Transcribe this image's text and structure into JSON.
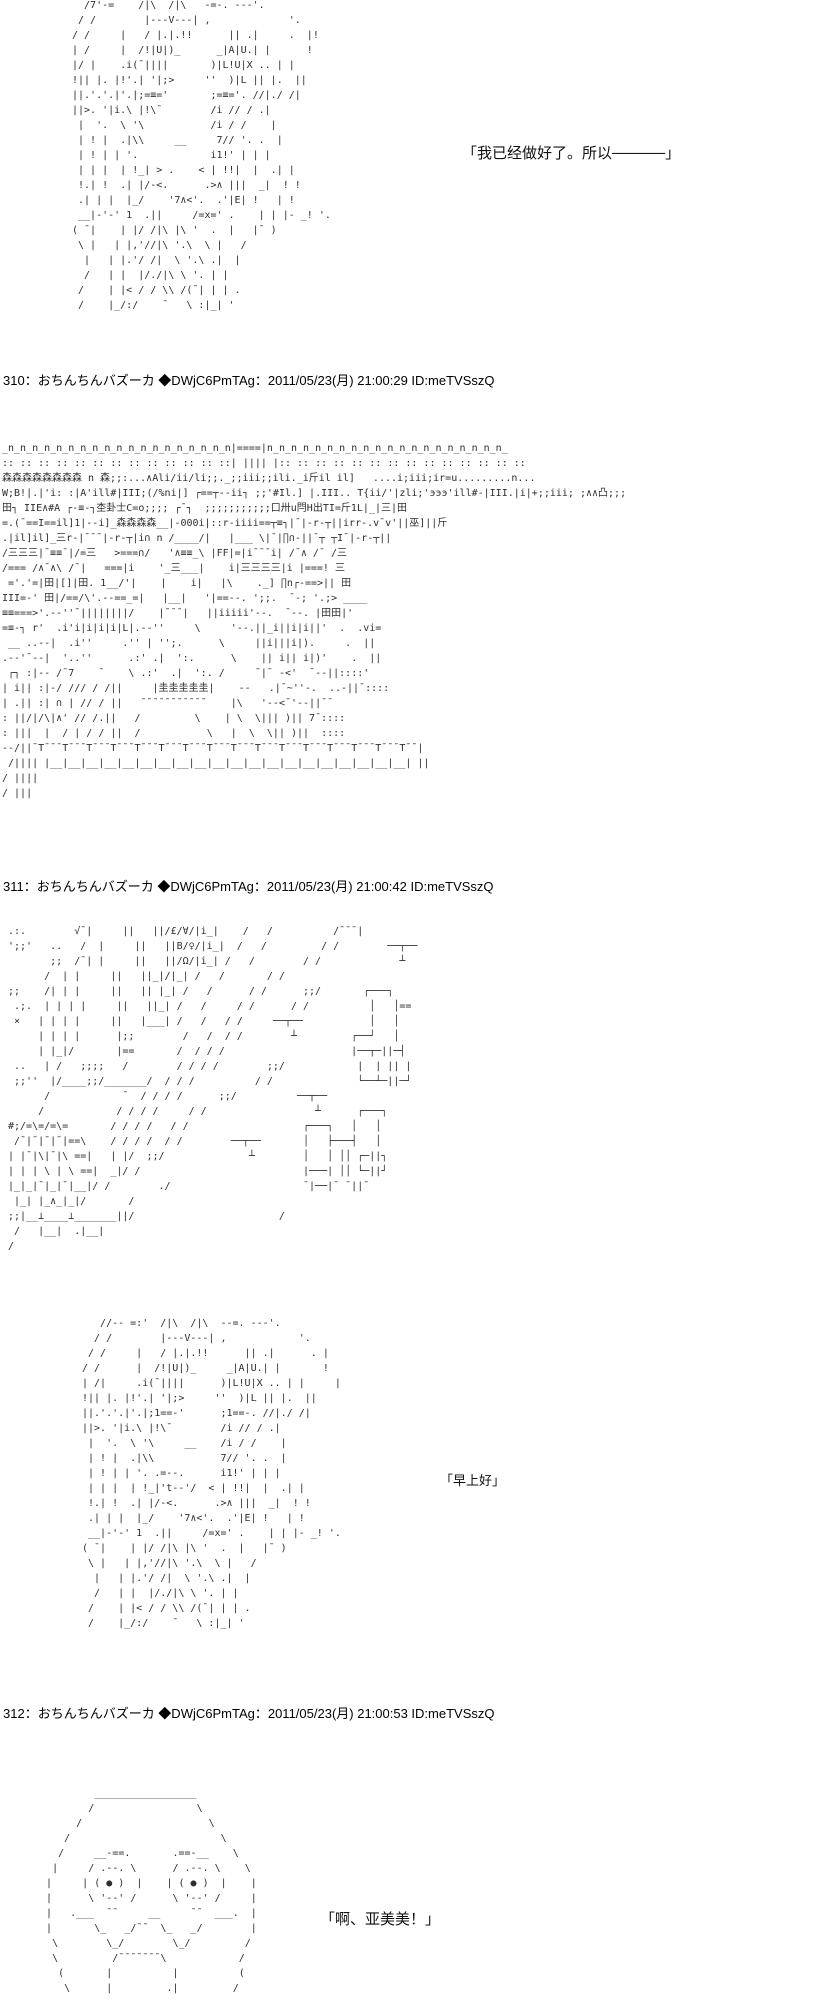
{
  "page": {
    "background": "#ffffff",
    "text_color": "#000000",
    "aa_color": "#2e2e2e",
    "kind": "ascii-art thread page"
  },
  "posts": [
    {
      "role": "previous-post-tail",
      "dialogue": "「我已经做好了。所以─────」",
      "aa_character": [
        "  /7'-=    /|\\  /|\\   -=-. ---'.",
        " / /        |---V---| ,             '.",
        "/ /     |   / |.|.!!      || .|     .  |!",
        "| /     |  /!|U|)_      _|A|U.| |      !",
        "|/ |    .i(¯||||       )|L!U|X .. | |",
        "!|| |. |!'.| '|;>     ''  )|L || |.  ||",
        "||.'.'.|'.|;=≡='       ;=≡='. //|./ /|",
        "||>. '|i.\\ |!\\¯        /i // / .|",
        " |  '.  \\ '\\           /i / /    |",
        " | ! |  .|\\\\     __     7// '. .  |",
        " | ! | | '.            i1!' | | |",
        " | | |  | !_| > .    < | !!|  |  .| |",
        " !.| !  .| |/-<.      .>∧ |||  _|  ! !",
        " .| | |  |_/    '7∧<'.  .'|E| !   | !",
        " __|-'-' 1  .||     /=x=' .    | | |- _! '.",
        "( ¯|    | |/ /|\\ |\\ '  .  |   |¯ )",
        " \\ |   | |,'//|\\ '.\\  \\ |   /",
        "  |   | |.'/ /|  \\ '.\\ .|  |",
        "  /   | |  |/./|\\ \\ '. | |",
        " /    | |< / / \\\\ /(¯| | | .",
        " /    |_/:/    ¯   \\ :|_| '"
      ]
    },
    {
      "number": "310",
      "header": "310：おちんちんバズーカ ◆DWjC6PmTAg：2011/05/23(月) 21:00:29 ID:meTVSszQ",
      "aa_scene": [
        "_n_n_n_n_n_n_n_n_n_n_n_n_n_n_n_n_n_n_n|====|n_n_n_n_n_n_n_n_n_n_n_n_n_n_n_n_n_n_n_n_",
        ":: :: :: :: :: :: :: :: :: :: :: :: ::| |||| |:: :: :: :: :: :: :: :: :: :: :: :: :: ::",
        "森森森森森森森森 n 森;;:...∧Ali/ii/li;;._;;iii;;ili._i斤il il]   ....i;iii;ir=u.........n...",
        "W;B!|.|'i: :|A'ill#|III;(/%ni|] ┌==┬--ii┐ ;;'#Il.] |.III.. T{ii/'|zli;'эээ'ill#-|III.|i|+;;iii; ;∧∧凸;;;",
        "田┐ IIE∧#A ┌-≡-┐杢卦士C=o;;;; ┌¯┐  ;;;;;;;;;;;口卅u閂H出TI=斤1L|_|三|田",
        "=.(¯==I==il]1|--i]_森森森森__|-000i|::r-iiii==┬≡┐|¯|-r-┬||irr-.v¯v'||巫]||斤",
        ".|il]il]_三r-|¯¯¯|-r-┬|i∩ n /____/|   |___ \\|¯|∏∩-||¯┬ ┬I¯|-r-┬||",
        "/三三三|¯≡≡¯|/=三   >===∩/   '∧≡≡_\\ |FF|=|i¯¯¯i| /¯∧ /¯ /三",
        "/=== /∧¯∧\\ /¯|   ===|i    '_三___|    i|三三三三|i |===! 三",
        " ='.'=|田|[]|田. 1__/'|    |    i|   |\\    ._] ∏n┌-==>|| 田",
        "III=-' 田|/==/\\'.--==_=|   |__|   '|==--. ';;.  ¯-; '.;> ____",
        "≡≡===>'.--''¯||||||||/    |¯¯¯|   ||iiiii'--.  ¯--. |田田|'",
        "=≡-┐ r'  .i'i|i|i|i|L|.--''     \\     '--.||_i||i|i||'  .  .vi=",
        " __ ..--|  .i''     .'' | '';.      \\     ||i|||i|).     .  ||",
        ".--'¯--|  '..''      .:' .|  ':.      \\    || i|| i|)'    .  ||",
        " ┌┐ :|-- /¯7    ¯    \\ .:'  .|  ':. /     ¯|¯ -<'  ¯--||::::'",
        "| i|| :|-/ /// / /||     |圭圭圭圭圭|    --   .|¯~''-.  ..-||¯::::",
        "| .|| :| ∩ | // / ||   ¯¯¯¯¯¯¯¯¯¯¯    |\\   '--<¯'--||¯¯",
        ": ||/|/\\|∧' // /.||   /         \\    | \\  \\||| )|| 7¯::::",
        ": |||  |  / | / / ||  /           \\   |  \\  \\|| )||  ::::",
        "--/||¯T¯¯¯T¯¯¯T¯¯¯T¯¯¯T¯¯¯T¯¯¯T¯¯¯T¯¯¯T¯¯¯T¯¯¯T¯¯¯T¯¯¯T¯¯¯T¯¯¯T¯¯¯T¯¯|",
        " /|||| |__|__|__|__|__|__|__|__|__|__|__|__|__|__|__|__|__|__|__|__| ||",
        "/ ||||",
        "/ |||"
      ]
    },
    {
      "number": "311",
      "header": "311：おちんちんバズーカ ◆DWjC6PmTAg：2011/05/23(月) 21:00:42 ID:meTVSszQ",
      "dialogue": "「早上好」",
      "aa_room": [
        ".:.        √¯|     ||   ||/£/∀/|i_|    /   /          /¯¯¯|",
        "';;'   ..   /  |     ||   ||B/♀/|i_|  /   /         / /        ──┬──",
        "       ;;  /¯| |     ||   ||/Ω/|i_| /   /        / /             ┴",
        "      /  | |     ||   ||_|/|_| /   /       / /",
        ";;    /| | |     ||   || |_| /   /      / /      ;;/       ┌───┐",
        " .;.  | | | |     ||   ||_| /   /     / /      / /          │   │==",
        " ×   | | | |     ||   |___| /   /   / /     ──┬──           │   │",
        "     | | | |      |;;        /   /  / /        ┴         ┌──┘   │",
        "     | |_|/       |==       /  / / /                     |──┬─||─┤",
        " ..   | /   ;;;;   /        / / / /        ;;/            |  | || |",
        " ;;''  |/____;;/_______/  / / /          / /              └──┴─||─┘",
        "      /            ¯  / / / /      ;;/          ──┬──",
        "     /            / / / /     / /                  ┴      ┌───┐",
        "#;/=\\=/=\\=       / / / /   / /                   ┌───┐   │   │",
        " /¯|¯|¯|¯|==\\    / / / /  / /        ──┬──       │   ├───┤   │",
        "| |¯|\\|¯|\\ ==|   | |/  ;;/              ┴        │   │ ││ ┌─||┐",
        "| | | \\ | \\ ==|  _|/ /                           |───| ││ └─||┘",
        "|_|_|¯|_|¯|__|/ /        ./                      ¯|──|¯ ¯||¯",
        " |_| |_∧_|_|/       /",
        ";;|__⊥____⊥_______||/                        /",
        " /   |__|  .|__|",
        "/",
        ""
      ],
      "aa_character": [
        "   //-- =:'  /|\\  /|\\  --=. ---'.",
        "  / /        |---V---| ,            '.",
        " / /     |   / |.|.!!      || .|      . |",
        "/ /      |  /!|U|)_     _|A|U.| |       !",
        "| /|     .i(¯||||      )|L!U|X .. | |     |",
        "!|| |. |!'.| '|;>     ''  )|L || |.  ||",
        "||.'.'.|'.|;1==-'      ;1==-. //|./ /|",
        "||>. '|i.\\ |!\\¯        /i // / .|",
        " |  '.  \\ '\\     __    /i / /    |",
        " | ! |  .|\\\\           7// '. .  |",
        " | ! | | '. .=--.      i1!' | | |",
        " | | |  | !_|'t--'/  < | !!|  |  .| |",
        " !.| !  .| |/-<.      .>∧ |||  _|  ! !",
        " .| | |  |_/    '7∧<'.  .'|E| !   | !",
        " __|-'-' 1  .||     /=x=' .    | | |- _! '.",
        "( ¯|    | |/ /|\\ |\\ '  .  |   |¯ )",
        " \\ |   | |,'//|\\ '.\\  \\ |   /",
        "  |   | |.'/ /|  \\ '.\\ .|  |",
        "  /   | |  |/./|\\ \\ '. | |",
        " /    | |< / / \\\\ /(¯| | | .",
        " /    |_/:/    ¯   \\ :|_| '"
      ]
    },
    {
      "number": "312",
      "header": "312：おちんちんバズーカ ◆DWjC6PmTAg：2011/05/23(月) 21:00:53 ID:meTVSszQ",
      "dialogue": "「啊、亚美美！」",
      "aa_face": [
        "           _________________",
        "          /                 \\",
        "        /                     \\",
        "      /                         \\",
        "     /     __-==.       .==-__    \\",
        "    |     / .--. \\      / .--. \\    \\",
        "   |     | ( ● )  |    | ( ● )  |    |",
        "   |      \\ '--' /      \\ '--' /     |",
        "   |   .___  ¯¯     __     ¯¯  ___.  |",
        "   |       \\_   _/¯¯  \\_   _/        |",
        "    \\        \\_/        \\_/         /",
        "    \\         /¯¯¯¯¯¯¯\\            /",
        "     (       |          |          (",
        "      \\      |         .|         /"
      ]
    }
  ]
}
